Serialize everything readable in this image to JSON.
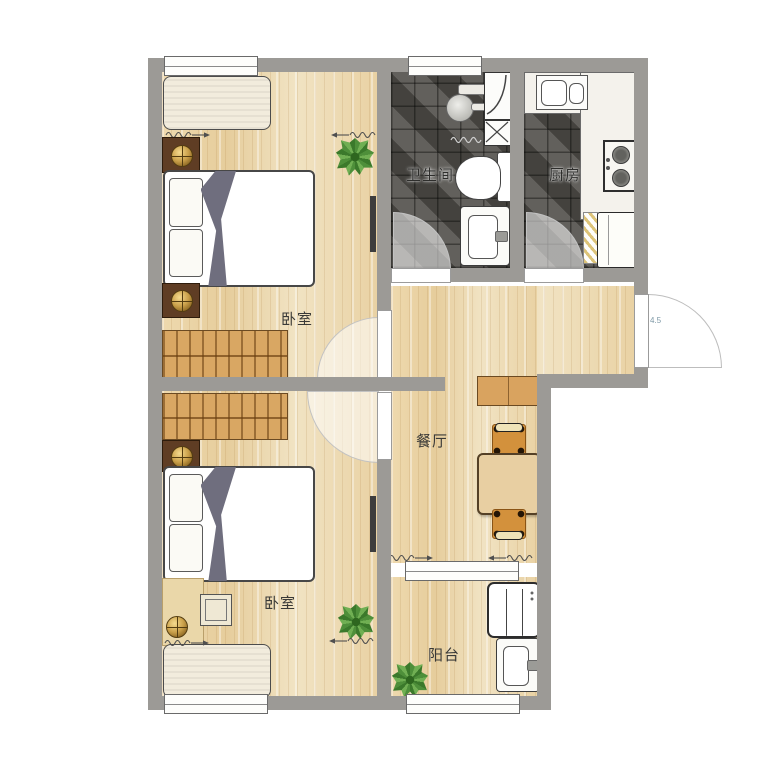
{
  "plan": {
    "title_hint": "apartment floor plan",
    "rooms": [
      {
        "id": "bedroom-top",
        "label": "卧室"
      },
      {
        "id": "bathroom",
        "label": "卫生间"
      },
      {
        "id": "kitchen",
        "label": "厨房"
      },
      {
        "id": "dining",
        "label": "餐厅"
      },
      {
        "id": "bedroom-bottom",
        "label": "卧室"
      },
      {
        "id": "balcony",
        "label": "阳台"
      }
    ],
    "annotations": {
      "entry_door_dimension": "4.5"
    },
    "colors": {
      "wall": "#9c9a96",
      "wood_floor": "#ecd8ad",
      "dark_tile": "#55534e",
      "wardrobe_wood": "#d9a763",
      "nightstand_wood": "#5f3d24",
      "chair_wood": "#d3913c",
      "blanket": "#6f6e7e",
      "plant_green": "#4e8f3a",
      "background": "#ffffff"
    },
    "furniture_icons": [
      "bed",
      "pillow",
      "blanket",
      "nightstand",
      "wardrobe",
      "window-bench",
      "plant",
      "tv",
      "desk",
      "desk-chair",
      "dining-table",
      "dining-chair",
      "sideboard",
      "toilet",
      "wash-basin",
      "shower-head",
      "shower-glass",
      "duct-x",
      "kitchen-sink",
      "stove",
      "fridge",
      "drying-rack",
      "washing-machine",
      "mop-sink",
      "door-swing-arc",
      "curtain-symbol",
      "window"
    ]
  }
}
